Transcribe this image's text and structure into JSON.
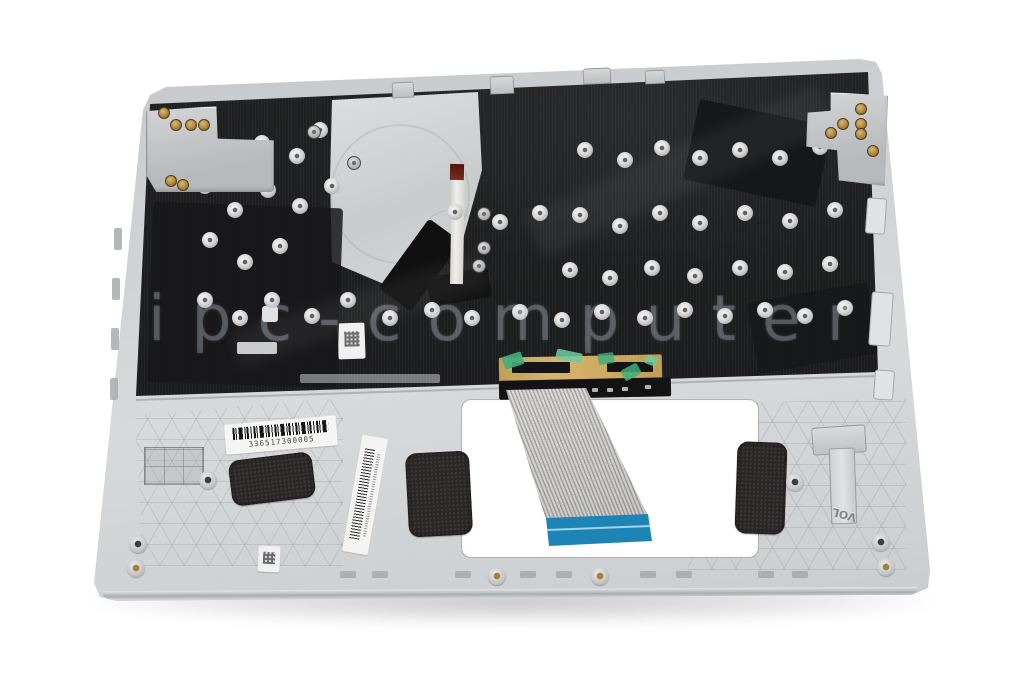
{
  "photo": {
    "subject": "laptop top case (palmrest with keyboard) underside view"
  },
  "watermark": {
    "text": "ipc-computer"
  },
  "labels": {
    "serial_barcode_number": "336517300005",
    "molded_text_vol": "VOL"
  },
  "colors": {
    "background": "#ffffff",
    "chassis_silver": "#ced1d3",
    "keyboard_plate_black": "#1d1e1f",
    "fan_plate_silver": "#d4d6d8",
    "ribbon_cable_gray": "#d6d4d1",
    "ribbon_end_blue": "#1d84b5",
    "connector_tan": "#cba95f",
    "tape_green": "#3fae7c",
    "foam_pad_dark": "#2b2726",
    "label_white": "#f5f5f4",
    "screw_gold": "#b0893f"
  }
}
